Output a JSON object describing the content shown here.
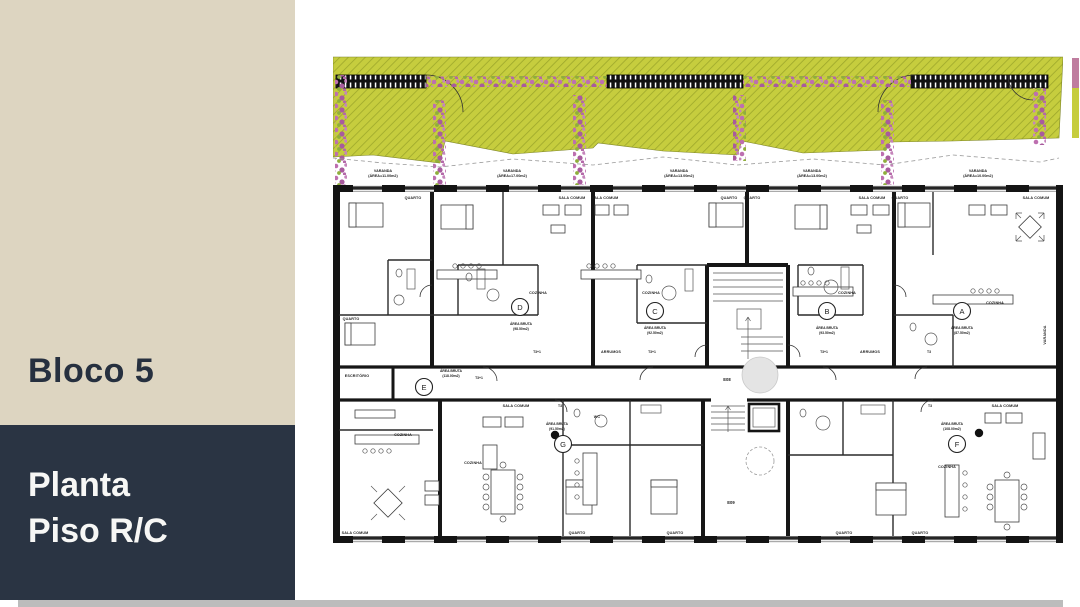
{
  "sidebar": {
    "title": "Bloco 5",
    "subtitle_line1": "Planta",
    "subtitle_line2": "Piso R/C",
    "beige": "#ddd5c1",
    "navy": "#2a3443"
  },
  "labels": {
    "quarto": "QUARTO",
    "sala_comum": "SALA COMUM",
    "cozinha": "COZINHA",
    "escritorio": "ESCRITÓRIO",
    "arrumos": "ARRUMOS",
    "wc": "WC",
    "varanda": "VARANDA",
    "area_bruta": "ÁREA BRUTA"
  },
  "verandas": [
    {
      "label": "VARANDA",
      "area": "(ÁREA=11.00m2)"
    },
    {
      "label": "VARANDA",
      "area": "(ÁREA=17.00m2)"
    },
    {
      "label": "VARANDA",
      "area": "(ÁREA=13.00m2)"
    },
    {
      "label": "VARANDA",
      "area": "(ÁREA=13.00m2)"
    },
    {
      "label": "VARANDA",
      "area": "(ÁREA=10.00m2)"
    }
  ],
  "units": [
    {
      "letter": "A",
      "area": "(87.50m2)",
      "type": "T3"
    },
    {
      "letter": "B",
      "area": "(93.50m2)",
      "type": "T3+1"
    },
    {
      "letter": "C",
      "area": "(92.50m2)",
      "type": "T3+1"
    },
    {
      "letter": "D",
      "area": "(98.50m2)",
      "type": "T3+1"
    },
    {
      "letter": "E",
      "area": "(118.00m2)",
      "type": "T3+1"
    },
    {
      "letter": "F",
      "area": "(108.00m2)",
      "type": "T3"
    },
    {
      "letter": "G",
      "area": "(91.50m2)",
      "type": "T3"
    }
  ],
  "corridor": {
    "upper_code": "E08",
    "lower_code": "E09"
  },
  "colors": {
    "garden": "#c6cd3e",
    "garden_hatch": "#9da72b",
    "flowers": "#bd6fb0",
    "walls": "#161616"
  }
}
